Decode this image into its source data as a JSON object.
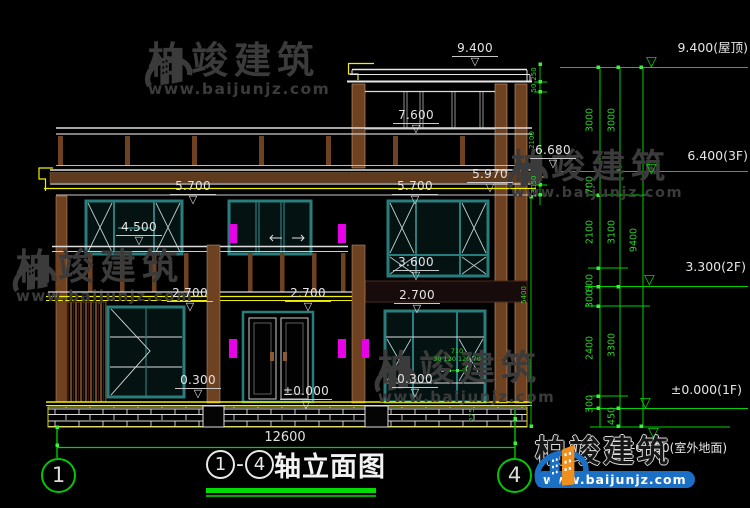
{
  "colors": {
    "background": "#000000",
    "line_white": "#e8e8e8",
    "line_yellow": "#f0f000",
    "line_green": "#00d400",
    "frame_teal": "#2a7d7d",
    "wood_brown": "#6e4120",
    "lamp_magenta": "#e800e8",
    "watermark_gray": "#3b3b3b",
    "logo_blue": "#1b6fc4",
    "logo_orange": "#ef8f1f"
  },
  "watermark": {
    "brand": "柏竣建筑",
    "site": "www.baijunjz.com"
  },
  "footer": {
    "brand": "柏竣建筑",
    "site": "www.baijunjz.com"
  },
  "title": {
    "axis_from": "1",
    "dash": "-",
    "axis_to": "4",
    "name": "轴立面图"
  },
  "axes": {
    "left_bubble": "1",
    "right_bubble": "4"
  },
  "dims": {
    "total_width": "12600",
    "levels": [
      {
        "t": "9.400",
        "x": 452,
        "y": 42
      },
      {
        "t": "7.600",
        "x": 393,
        "y": 109
      },
      {
        "t": "6.680",
        "x": 530,
        "y": 144
      },
      {
        "t": "5.970",
        "x": 467,
        "y": 168
      },
      {
        "t": "5.700",
        "x": 170,
        "y": 180
      },
      {
        "t": "5.700",
        "x": 392,
        "y": 180
      },
      {
        "t": "4.500",
        "x": 116,
        "y": 221
      },
      {
        "t": "3.600",
        "x": 393,
        "y": 256
      },
      {
        "t": "2.700",
        "x": 167,
        "y": 287
      },
      {
        "t": "2.700",
        "x": 285,
        "y": 287
      },
      {
        "t": "2.700",
        "x": 394,
        "y": 289
      },
      {
        "t": "0.300",
        "x": 175,
        "y": 374
      },
      {
        "t": "0.300",
        "x": 392,
        "y": 373
      },
      {
        "t": "±0.000",
        "x": 280,
        "y": 385,
        "w": 52
      }
    ],
    "right_markers": [
      {
        "t": "9.400(屋顶)",
        "x": 630,
        "y": 37
      },
      {
        "t": "6.400(3F)",
        "x": 630,
        "y": 148
      },
      {
        "t": "3.300(2F)",
        "x": 628,
        "y": 259
      },
      {
        "t": "±0.000(1F)",
        "x": 624,
        "y": 382
      },
      {
        "t": "-0.450(室外地面)",
        "x": 620,
        "y": 427,
        "flip": true
      }
    ],
    "chain": [
      {
        "t": "3000",
        "x": 590,
        "y": 120
      },
      {
        "t": "700",
        "x": 590,
        "y": 185
      },
      {
        "t": "2100",
        "x": 590,
        "y": 232
      },
      {
        "t": "600",
        "x": 590,
        "y": 283
      },
      {
        "t": "300",
        "x": 590,
        "y": 299
      },
      {
        "t": "2400",
        "x": 590,
        "y": 348
      },
      {
        "t": "300",
        "x": 590,
        "y": 404
      },
      {
        "t": "3000",
        "x": 612,
        "y": 120
      },
      {
        "t": "3100",
        "x": 612,
        "y": 232
      },
      {
        "t": "3300",
        "x": 612,
        "y": 345
      },
      {
        "t": "450",
        "x": 612,
        "y": 416
      },
      {
        "t": "9400",
        "x": 634,
        "y": 240
      }
    ],
    "micro": [
      {
        "t": "250",
        "x": 534,
        "y": 74,
        "r": 1
      },
      {
        "t": "50",
        "x": 534,
        "y": 88,
        "r": 1
      },
      {
        "t": "2100",
        "x": 532,
        "y": 140,
        "r": 1
      },
      {
        "t": "50",
        "x": 534,
        "y": 180,
        "r": 1
      },
      {
        "t": "130",
        "x": 534,
        "y": 191,
        "r": 1
      },
      {
        "t": "5400",
        "x": 524,
        "y": 295,
        "r": 1
      },
      {
        "t": "275",
        "x": 472,
        "y": 415,
        "r": 1
      },
      {
        "t": "710",
        "x": 457,
        "y": 351,
        "r": 0
      },
      {
        "t": "30 120 120 70",
        "x": 457,
        "y": 359,
        "r": 0
      }
    ]
  }
}
